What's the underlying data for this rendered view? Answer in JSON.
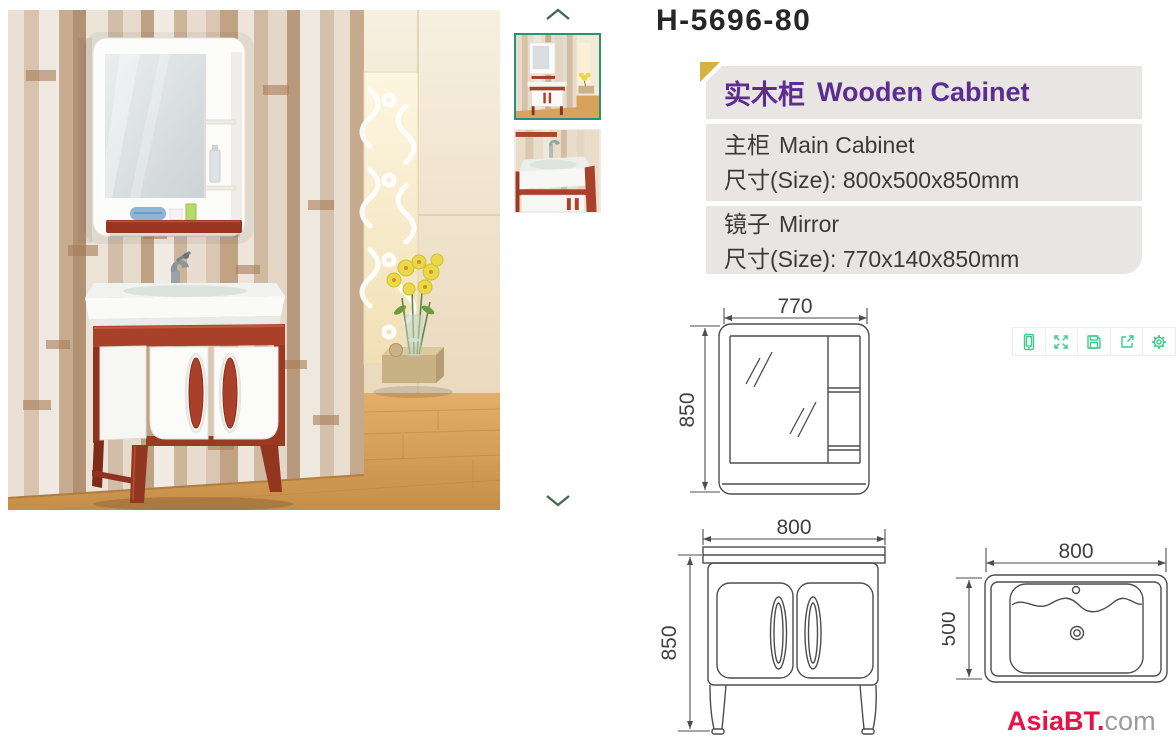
{
  "product": {
    "model": "H-5696-80",
    "category": {
      "cn": "实木柜",
      "en": "Wooden Cabinet",
      "accent_color": "#5b2d90"
    },
    "specs": [
      {
        "cn": "主柜",
        "en": "Main Cabinet",
        "size": "尺寸(Size): 800x500x850mm"
      },
      {
        "cn": "镜子",
        "en": "Mirror",
        "size": "尺寸(Size): 770x140x850mm"
      }
    ]
  },
  "gallery": {
    "main_image_alt": "Red-brown and white bathroom vanity with mirror on a wood plank wall",
    "thumbnails": [
      {
        "alt": "Full bathroom scene",
        "selected": true
      },
      {
        "alt": "Ceramic basin close-up",
        "selected": false
      }
    ],
    "controls": {
      "up_icon": "chevron-up",
      "down_icon": "chevron-down",
      "arrow_color": "#446a52"
    },
    "selected_border_color": "#2e8f72"
  },
  "drawings": {
    "line_color": "#4d4d4d",
    "mirror": {
      "width": "770",
      "height": "850"
    },
    "cabinet": {
      "width": "800",
      "height": "850"
    },
    "basin": {
      "width": "800",
      "height": "500"
    }
  },
  "toolbar": {
    "icon_color": "#3bcb8c",
    "icons": [
      "mobile-preview",
      "fullscreen",
      "save",
      "share",
      "settings"
    ]
  },
  "watermark": {
    "brand": "AsiaBT.",
    "suffix": "com",
    "brand_color": "#ea1146",
    "suffix_color": "#9c9c9c"
  }
}
